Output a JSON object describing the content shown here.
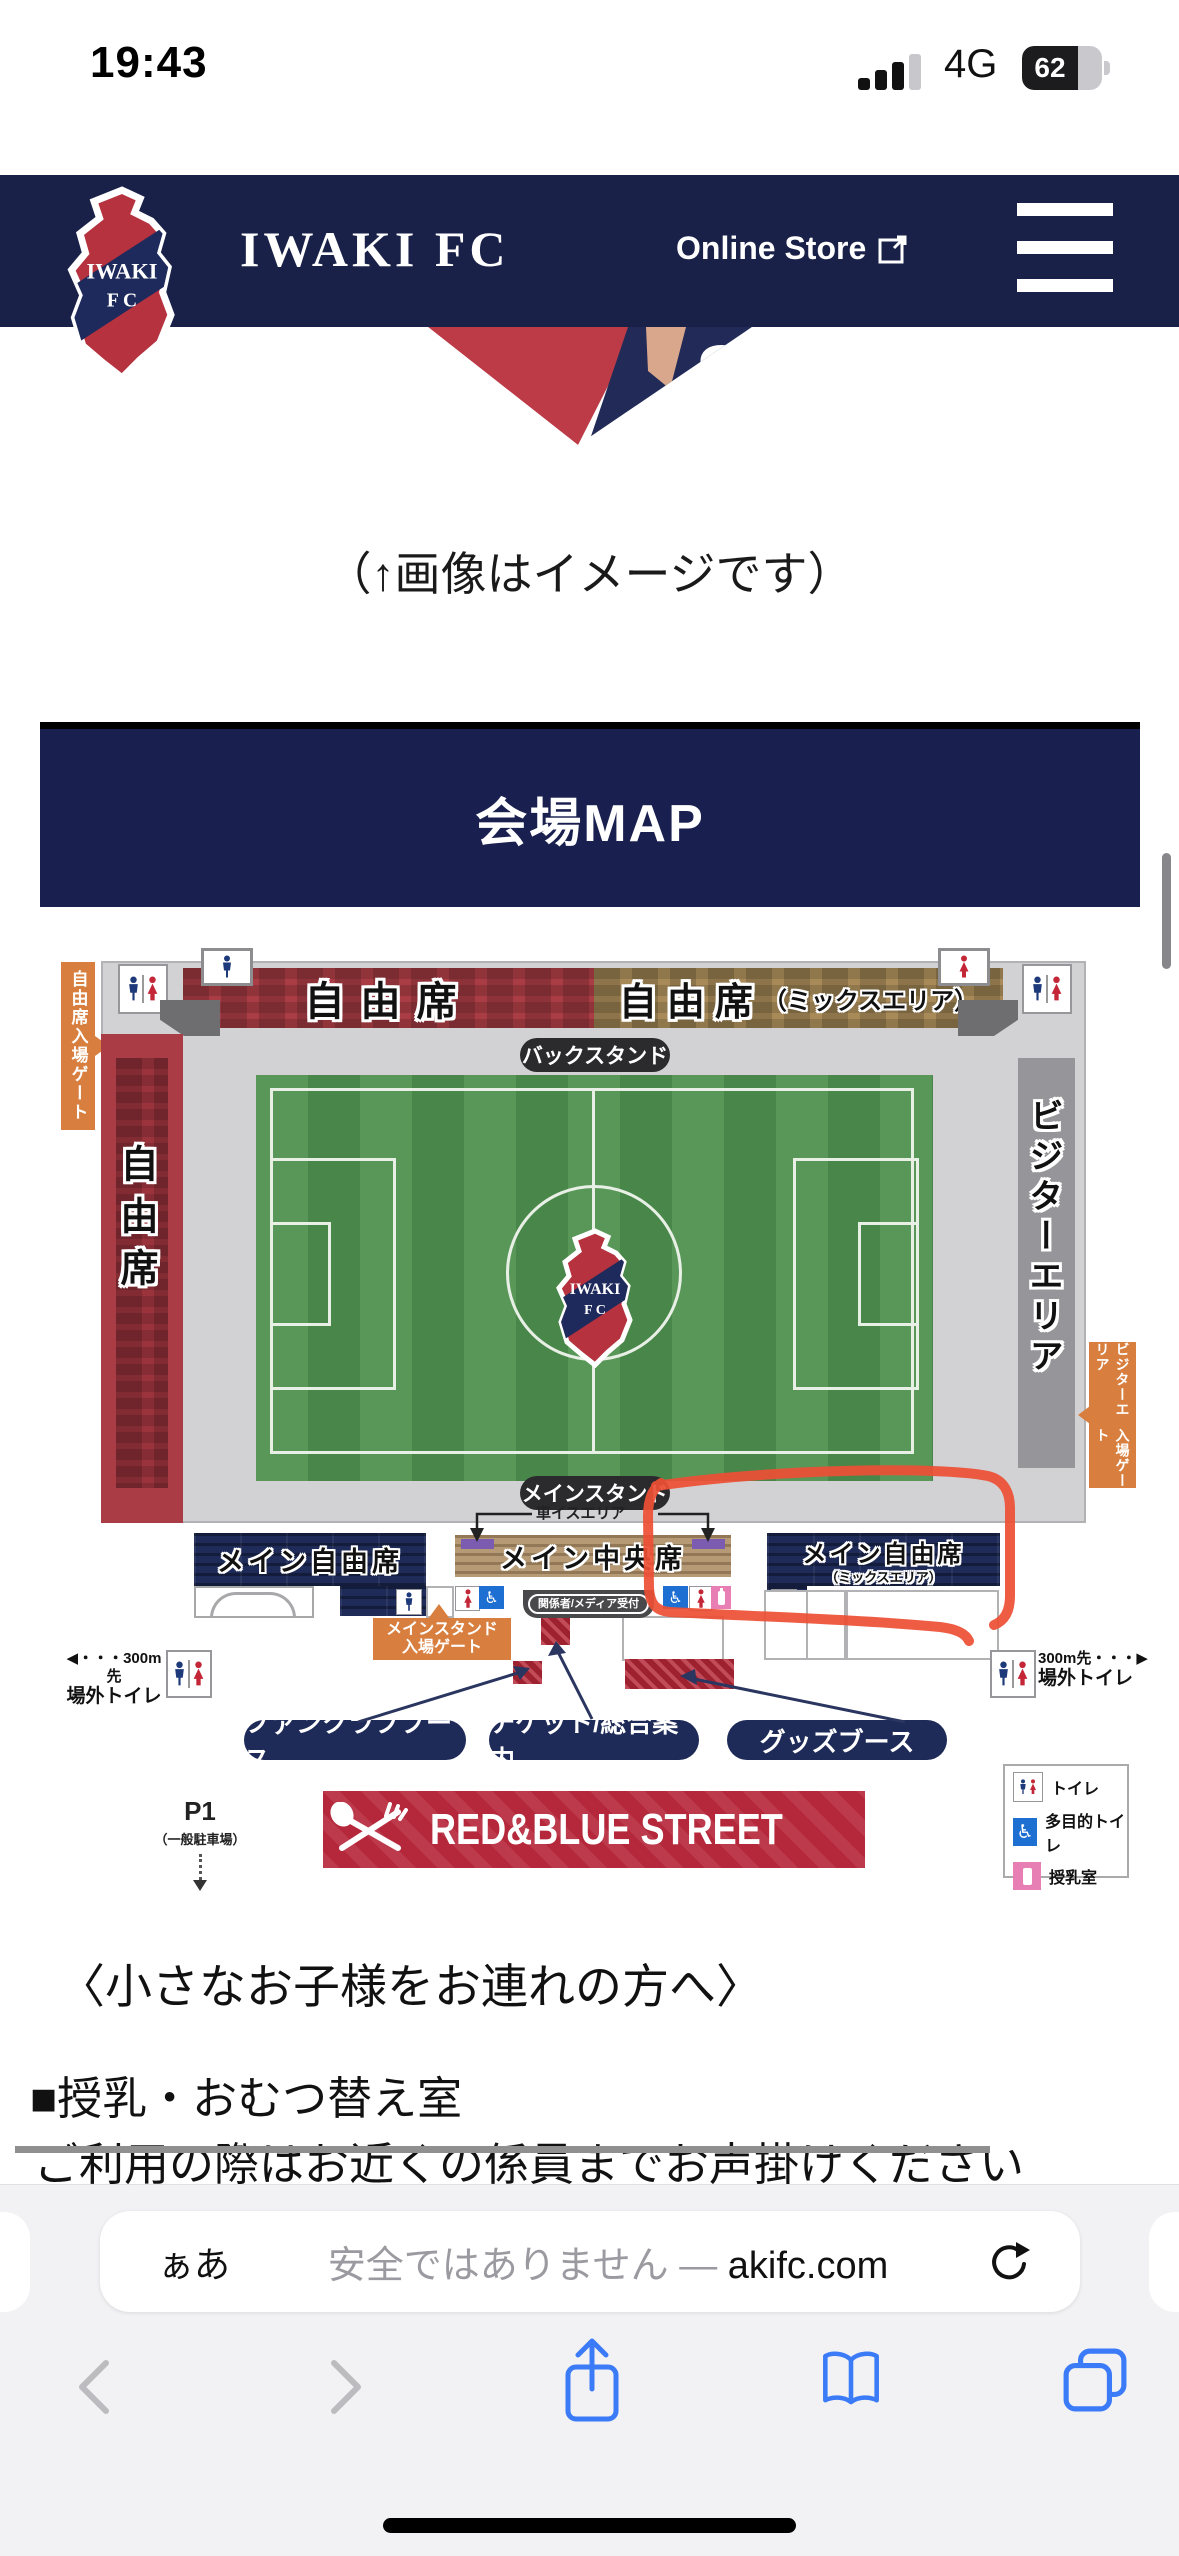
{
  "status": {
    "time": "19:43",
    "network": "4G",
    "battery": "62"
  },
  "header": {
    "brand": "IWAKI FC",
    "store": "Online Store",
    "crest_line1": "IWAKI",
    "crest_line2": "F C"
  },
  "hero": {
    "caption": "（↑画像はイメージです）",
    "jersey_number": "8"
  },
  "banner": {
    "title": "会場MAP"
  },
  "map": {
    "crest_line1": "IWAKI",
    "crest_line2": "F C",
    "stands": {
      "back_free": "自由席",
      "back_mix": "自由席",
      "back_mix_sub": "（ミックスエリア）",
      "left_free": "自由席",
      "visitor": "ビジターエリア",
      "main_left": "メイン自由席",
      "main_center": "メイン中央席",
      "main_right": "メイン自由席",
      "main_right_sub": "（ミックスエリア）"
    },
    "labels": {
      "back_stand": "バックスタンド",
      "main_stand": "メインスタンド",
      "wheelchair": "車イスエリア",
      "reception": "関係者/メディア受付"
    },
    "gates": {
      "free": "自由席入場ゲート",
      "visitor1": "ビジターエリア",
      "visitor2": "入場ゲート",
      "main1": "メインスタンド",
      "main2": "入場ゲート"
    },
    "outside": {
      "left1": "◀・・・300m先",
      "left2": "場外トイレ",
      "right1": "300m先・・・▶",
      "right2": "場外トイレ"
    },
    "booths": [
      "ファンクラブブース",
      "チケット/総合案内",
      "グッズブース"
    ],
    "legend": [
      "トイレ",
      "多目的トイレ",
      "授乳室"
    ],
    "parking": {
      "code": "P1",
      "note": "（一般駐車場）"
    },
    "street": "RED&BLUE STREET"
  },
  "content": {
    "heading": "〈小さなお子様をお連れの方へ〉",
    "sub": "■授乳・おむつ替え室",
    "body": "ご利用の際はお近くの係員までお声掛けください"
  },
  "browser": {
    "reader": "ぁあ",
    "security": "安全ではありません",
    "dash": "—",
    "domain": "akifc.com"
  },
  "colors": {
    "header_navy": "#1a2148",
    "banner_navy": "#191f4e",
    "block_navy": "#1e2a57",
    "band_red": "#a93c44",
    "band_tan": "#a88a58",
    "gate_orange": "#d87f3f",
    "pitch_green": "#4f914f",
    "stand_gray": "#d2d2d4",
    "annotation_red": "#ee4f35",
    "street_red": "#b5273a",
    "ios_blue": "#3b7bf7",
    "nursing_pink": "#e87fb4",
    "wheelchair_blue": "#1d6fd1"
  }
}
